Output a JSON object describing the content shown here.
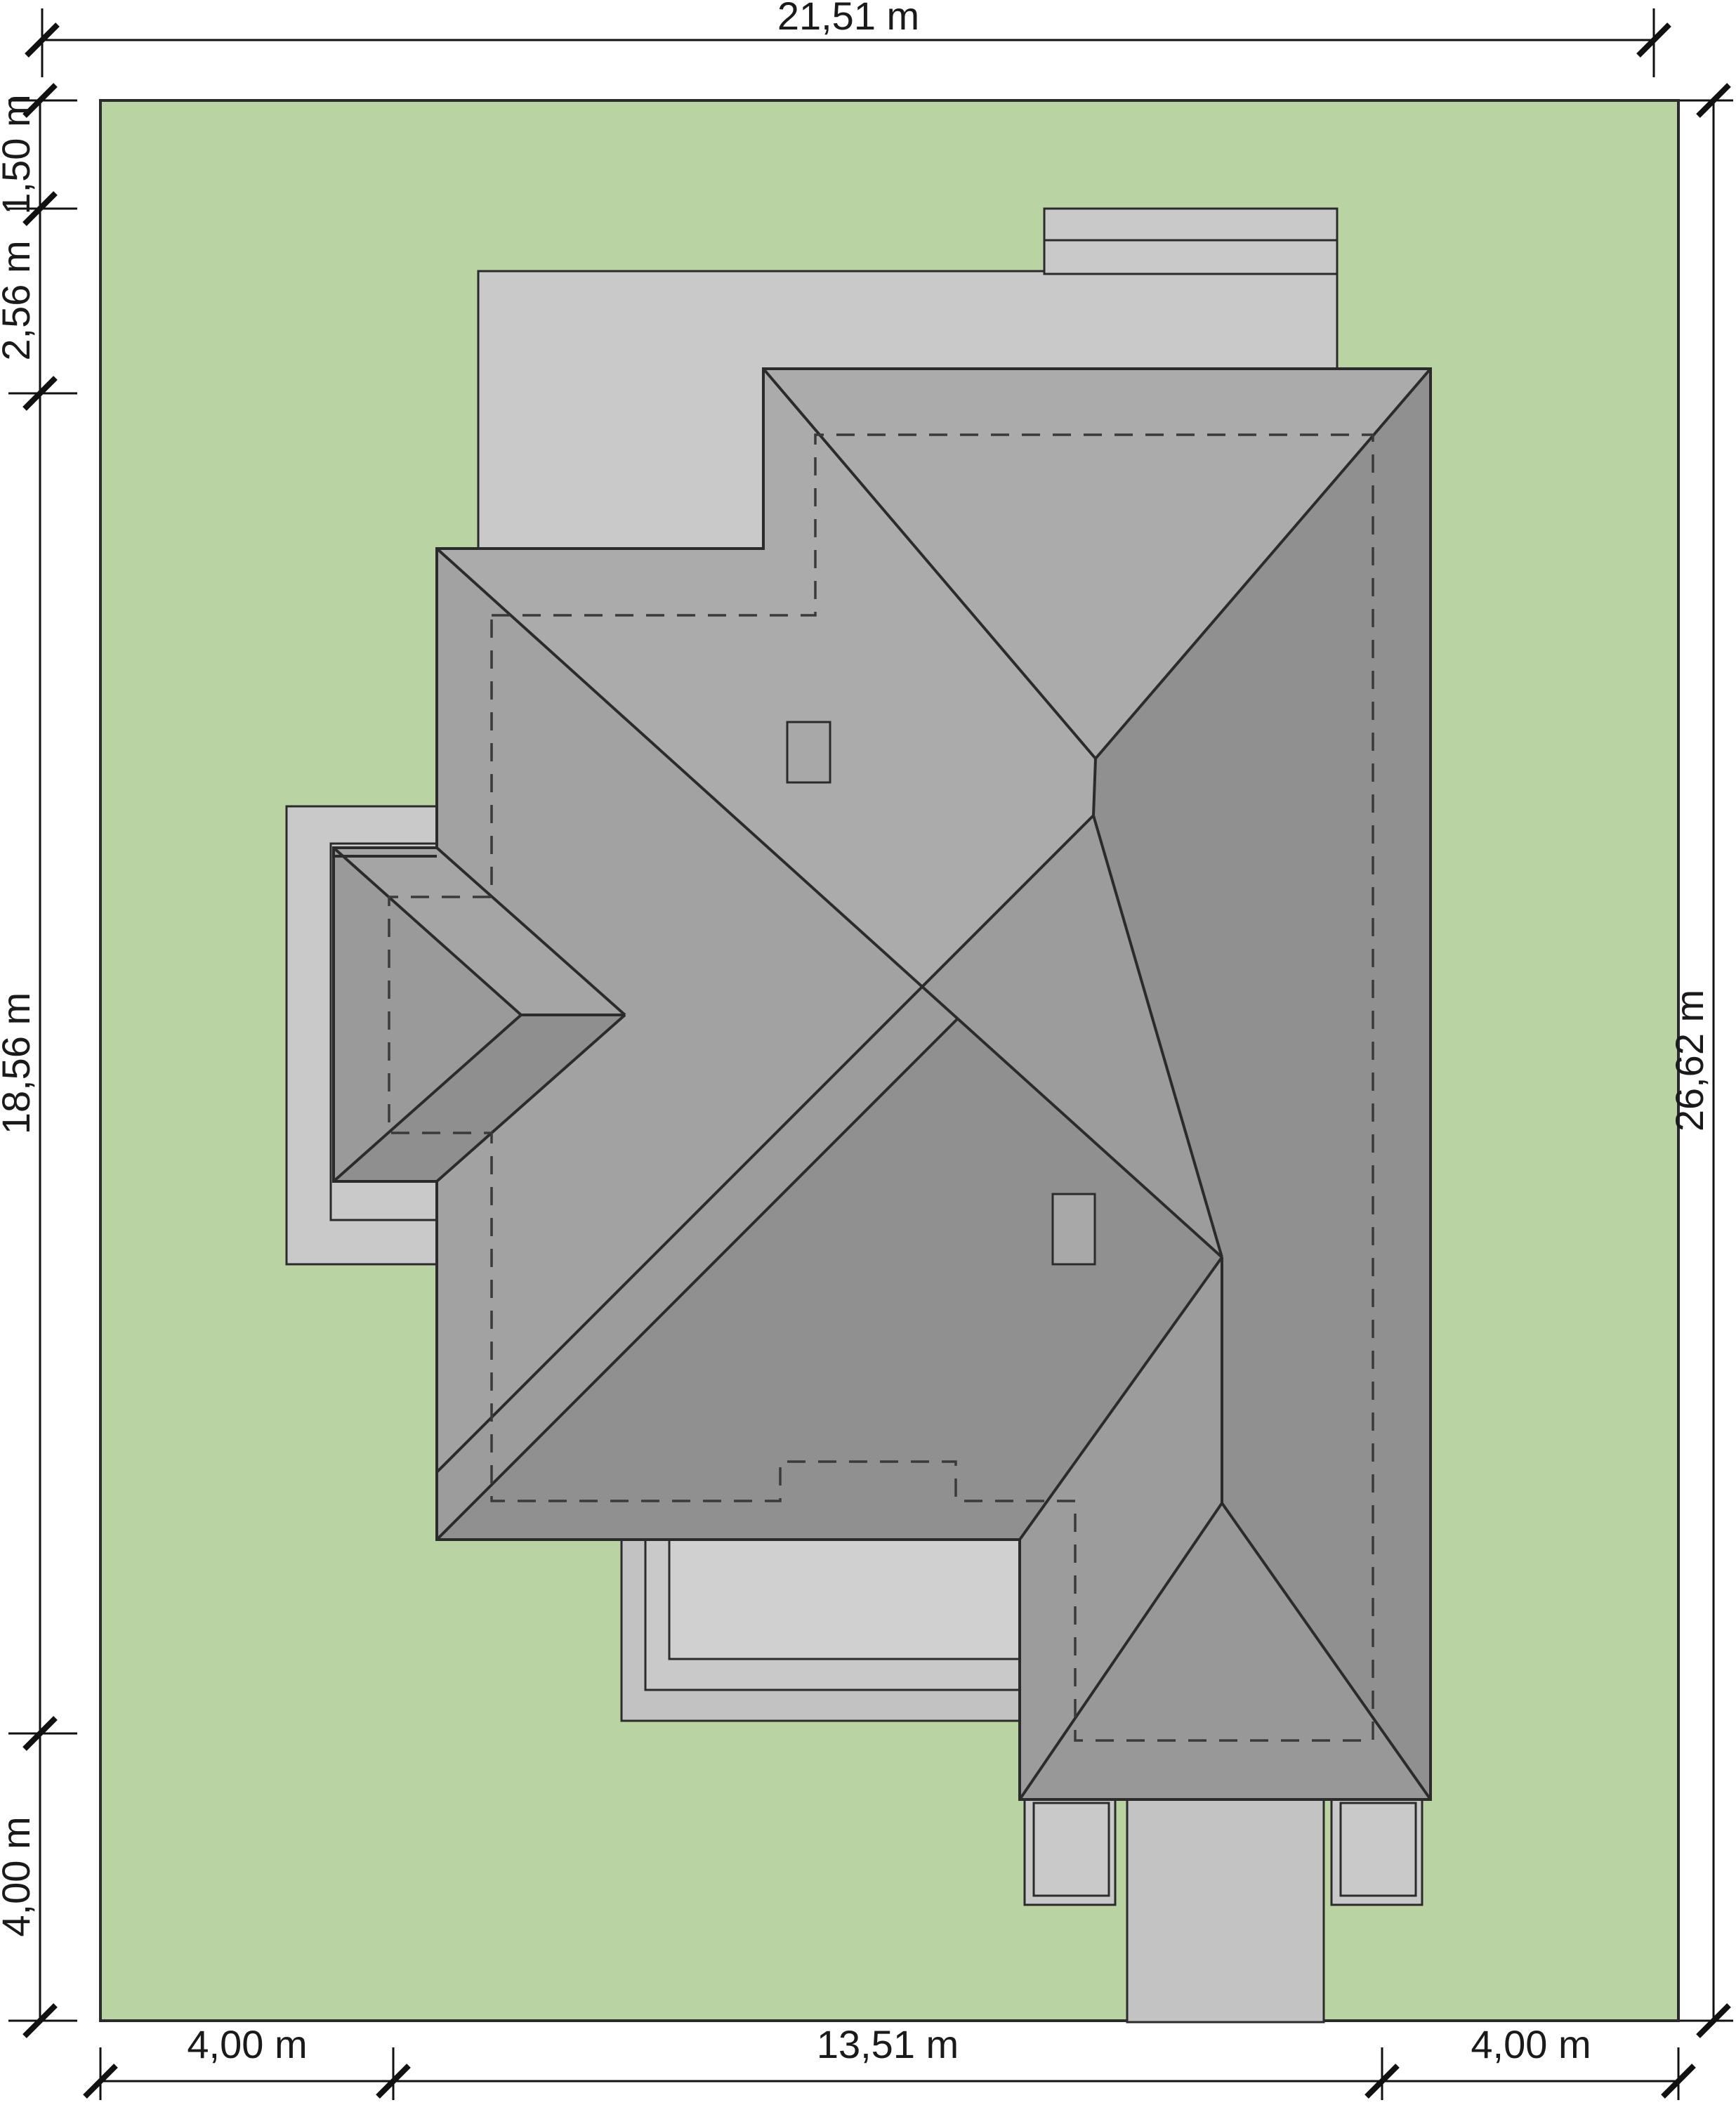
{
  "drawing": {
    "type": "site-plan-roof-view",
    "dimensions": {
      "top": {
        "total_width": "21,51 m"
      },
      "left": {
        "seg1": "1,50 m",
        "seg2": "2,56 m",
        "seg3": "18,56 m",
        "seg4": "4,00 m"
      },
      "right": {
        "total_height": "26,62 m"
      },
      "bottom": {
        "seg1": "4,00 m",
        "seg2": "13,51 m",
        "seg3": "4,00 m"
      }
    },
    "plot": {
      "width_m": 21.51,
      "height_m": 26.62,
      "side_setback_m": 4.0
    },
    "colors": {
      "plot_green": "#b9d3a2",
      "roof_base": "#a2a2a2",
      "roof_light": "#ababab",
      "roof_medium": "#9c9c9c",
      "roof_dark": "#909090",
      "roof_garage_south": "#989898",
      "bay_north": "#a5a5a5",
      "bay_west": "#9a9a9a",
      "bay_south": "#8f8f8f",
      "terrace_gray": "#c9c9c9",
      "terrace_dark": "#c2c2c2",
      "terrace_light": "#d0d0d0",
      "driveway": "#c3c3c3",
      "skylight": "#a8a8a8",
      "line_color": "#2b2b2b",
      "dash_color": "#3a3a3a",
      "dim_color": "#111111"
    }
  }
}
